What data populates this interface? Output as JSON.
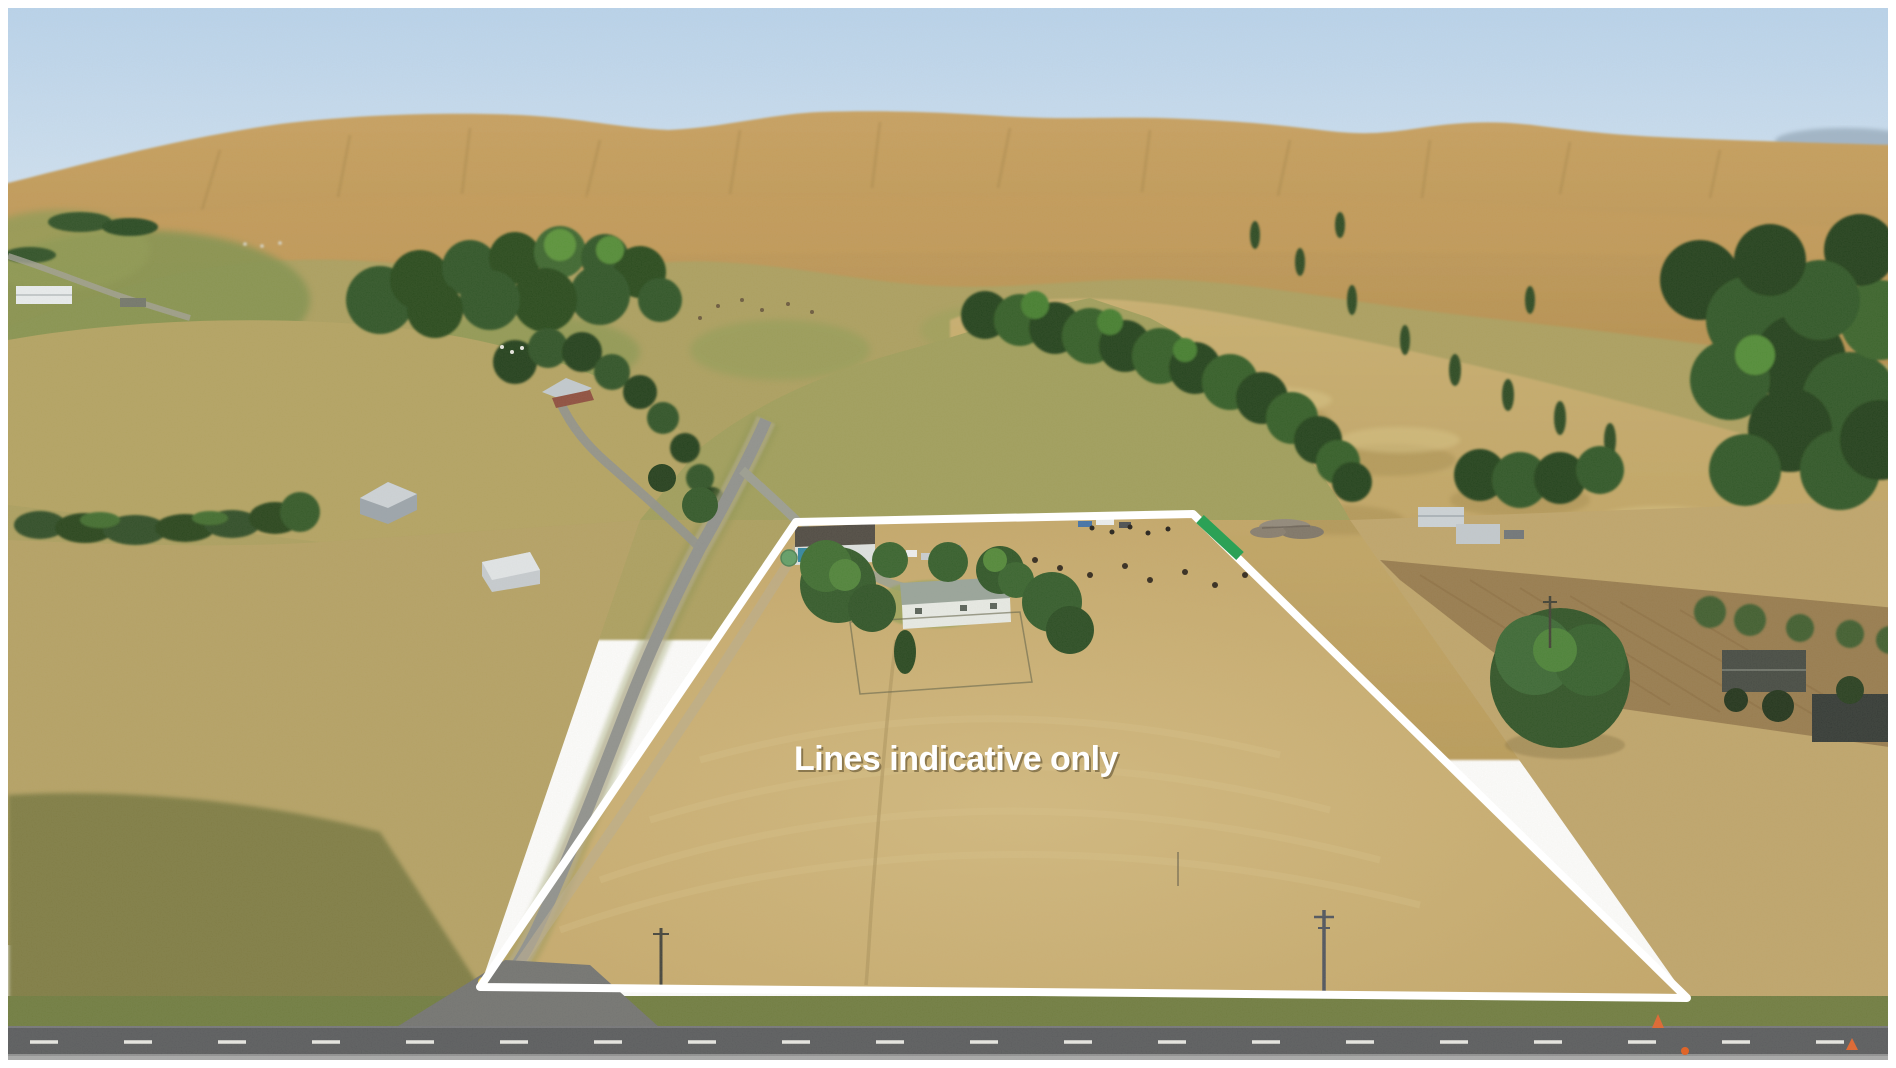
{
  "photo": {
    "kind": "aerial drone photograph",
    "scene": "dry golden farmland: rolling hills and shelterbelts behind a flat paddock block with a homestead, bordered by a highway along the bottom",
    "frame_color": "#ffffff",
    "caption": {
      "text": "Lines indicative only",
      "color": "#ffffff"
    }
  },
  "overlay": {
    "boundary_points": "796,522 1193,514 1687,998 480,987",
    "boundary_color": "#ffffff",
    "boundary_width": "8",
    "green_marker_path": "M1200,519 L1240,556",
    "green_marker_color": "#2ca156",
    "green_marker_width": "11"
  },
  "palette": {
    "sky_top": "#b7d3ee",
    "sky_horizon": "#dcebf8",
    "far_hills": "#c89f5c",
    "mid_hills": "#ab9e5b",
    "valley_green": "#83914b",
    "dunes": "#c6aa68",
    "tree_dark": "#1f3c18",
    "tree_mid": "#2f5a26",
    "tree_bright": "#4d8a33",
    "pasture_tan": "#b4a161",
    "paddock_tan": "#c6a866",
    "pasture_olive": "#7d7a41",
    "ploughed_brown": "#96794a",
    "verge_green": "#6d7a3c",
    "highway_asphalt": "#56585b",
    "road_dash": "#e9e9e5",
    "rural_road": "#8e908c",
    "gravel": "#b3aa90",
    "roof_light_gray": "#ccd3d8",
    "wall_white": "#e9ece7",
    "shed_door_teal": "#2e84a0",
    "house_roof_gray_green": "#97a399",
    "water_tank_green": "#5f9d64",
    "cone_orange": "#e0622a",
    "corner_marker_yellow": "#e7c337"
  },
  "landmarks": [
    "white property boundary outline with green gate marker at top-right corner",
    "homestead with sheds, trees and driveway inside boundary",
    "two light-gray barns on left pasture",
    "farmhouse among conifers upper left",
    "log pile and stock beyond top fence",
    "lone large tree and dark sheds at right",
    "rural road outside left boundary joining highway",
    "highway with dashed centerline across bottom"
  ]
}
